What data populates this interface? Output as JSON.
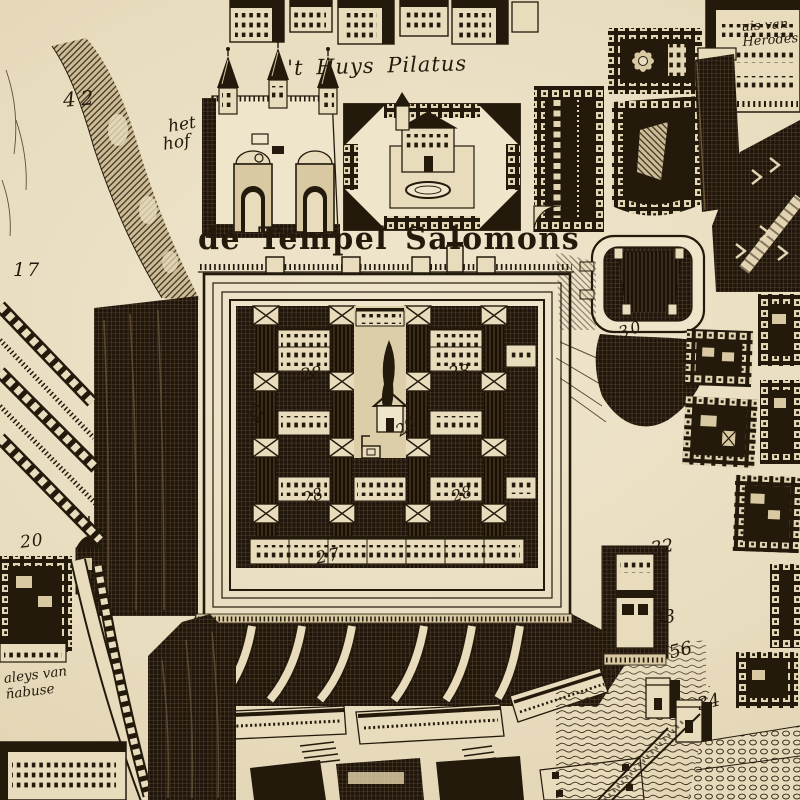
{
  "map": {
    "type": "antique-engraved-birdseye-map",
    "subject": "Temple of Solomon quarter of Jerusalem"
  },
  "palette": {
    "paper": "#e8dcbd",
    "paper_light": "#efe5ca",
    "paper_dark": "#d9c9a2",
    "ink": "#241a0c"
  },
  "labels": {
    "title": {
      "text": "de Tempel Salomons"
    },
    "huys_pilatus": {
      "text": "'t Huys Pilatus"
    },
    "het_hof": {
      "line1": "het",
      "line2": "hof"
    },
    "huis_herodes": {
      "line1": "uis van",
      "line2": "Herodes"
    },
    "paleys": {
      "line1": "aleys van",
      "line2": "ñabuse"
    },
    "numbers": {
      "n42": "42",
      "n17": "17",
      "n20": "20",
      "n27_west": "27",
      "n27_south": "27",
      "n28_nw": "28",
      "n28_ne": "28",
      "n28_sw": "28",
      "n28_se": "28",
      "n29": "29",
      "n30": "30",
      "n32": "32",
      "n33": "33",
      "n56": "56",
      "n34": "34"
    }
  }
}
